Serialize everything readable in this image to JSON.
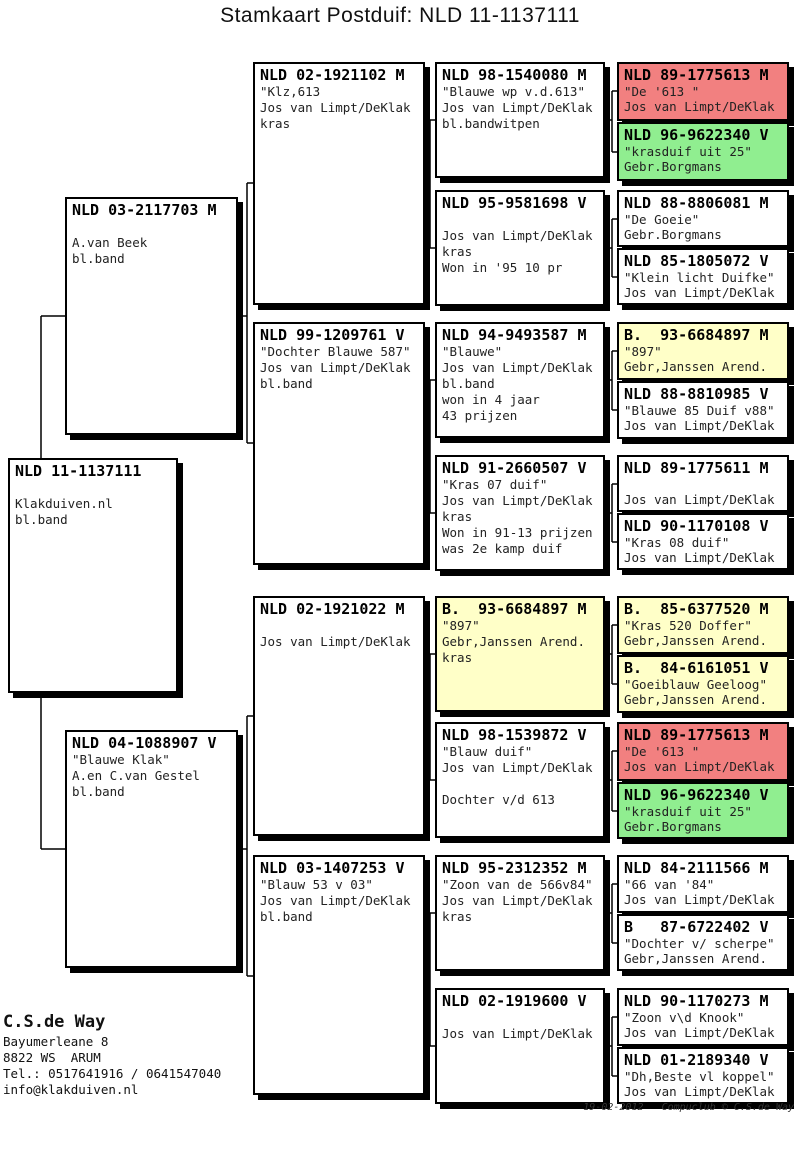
{
  "title": "Stamkaart Postduif: NLD 11-1137111",
  "colors": {
    "white": "#ffffff",
    "yellow": "#ffffc8",
    "red": "#f28080",
    "green": "#90ee90"
  },
  "boxes": [
    {
      "id": "subject",
      "header": "NLD 11-1137111",
      "body": "\nKlakduiven.nl\nbl.band"
    },
    {
      "id": "sire",
      "header": "NLD 03-2117703 M",
      "body": "\nA.van Beek\nbl.band"
    },
    {
      "id": "dam",
      "header": "NLD 04-1088907 V",
      "body": "\"Blauwe Klak\"\nA.en C.van Gestel\nbl.band"
    },
    {
      "id": "g3-1",
      "header": "NLD 02-1921102 M",
      "body": "\"Klz,613\nJos van Limpt/DeKlak\nkras"
    },
    {
      "id": "g3-2",
      "header": "NLD 99-1209761 V",
      "body": "\"Dochter Blauwe 587\"\nJos van Limpt/DeKlak\nbl.band"
    },
    {
      "id": "g3-3",
      "header": "NLD 02-1921022 M",
      "body": "\nJos van Limpt/DeKlak"
    },
    {
      "id": "g3-4",
      "header": "NLD 03-1407253 V",
      "body": "\"Blauw 53 v 03\"\nJos van Limpt/DeKlak\nbl.band"
    },
    {
      "id": "g4-1",
      "header": "NLD 98-1540080 M",
      "body": "\"Blauwe wp v.d.613\"\nJos van Limpt/DeKlak\nbl.bandwitpen"
    },
    {
      "id": "g4-2",
      "header": "NLD 95-9581698 V",
      "body": "\nJos van Limpt/DeKlak\nkras\nWon in '95 10 pr"
    },
    {
      "id": "g4-3",
      "header": "NLD 94-9493587 M",
      "body": "\"Blauwe\"\nJos van Limpt/DeKlak\nbl.band\nwon in 4 jaar\n43 prijzen"
    },
    {
      "id": "g4-4",
      "header": "NLD 91-2660507 V",
      "body": "\"Kras 07 duif\"\nJos van Limpt/DeKlak\nkras\nWon in 91-13 prijzen\nwas 2e kamp duif"
    },
    {
      "id": "g4-5",
      "header": "B.  93-6684897 M",
      "body": "\"897\"\nGebr,Janssen Arend.\nkras",
      "color": "yellow"
    },
    {
      "id": "g4-6",
      "header": "NLD 98-1539872 V",
      "body": "\"Blauw duif\"\nJos van Limpt/DeKlak\n\nDochter v/d 613"
    },
    {
      "id": "g4-7",
      "header": "NLD 95-2312352 M",
      "body": "\"Zoon van de 566v84\"\nJos van Limpt/DeKlak\nkras"
    },
    {
      "id": "g4-8",
      "header": "NLD 02-1919600 V",
      "body": "\nJos van Limpt/DeKlak"
    },
    {
      "id": "g5-01",
      "header": "NLD 89-1775613 M",
      "body": "\"De '613 \"\nJos van Limpt/DeKlak",
      "color": "red"
    },
    {
      "id": "g5-02",
      "header": "NLD 96-9622340 V",
      "body": "\"krasduif uit 25\"\nGebr.Borgmans",
      "color": "green"
    },
    {
      "id": "g5-03",
      "header": "NLD 88-8806081 M",
      "body": "\"De Goeie\"\nGebr.Borgmans"
    },
    {
      "id": "g5-04",
      "header": "NLD 85-1805072 V",
      "body": "\"Klein licht Duifke\"\nJos van Limpt/DeKlak"
    },
    {
      "id": "g5-05",
      "header": "B.  93-6684897 M",
      "body": "\"897\"\nGebr,Janssen Arend.",
      "color": "yellow"
    },
    {
      "id": "g5-06",
      "header": "NLD 88-8810985 V",
      "body": "\"Blauwe 85 Duif v88\"\nJos van Limpt/DeKlak"
    },
    {
      "id": "g5-07",
      "header": "NLD 89-1775611 M",
      "body": "\nJos van Limpt/DeKlak"
    },
    {
      "id": "g5-08",
      "header": "NLD 90-1170108 V",
      "body": "\"Kras 08 duif\"\nJos van Limpt/DeKlak"
    },
    {
      "id": "g5-09",
      "header": "B.  85-6377520 M",
      "body": "\"Kras 520 Doffer\"\nGebr,Janssen Arend.",
      "color": "yellow"
    },
    {
      "id": "g5-10",
      "header": "B.  84-6161051 V",
      "body": "\"Goeiblauw Geeloog\"\nGebr,Janssen Arend.",
      "color": "yellow"
    },
    {
      "id": "g5-11",
      "header": "NLD 89-1775613 M",
      "body": "\"De '613 \"\nJos van Limpt/DeKlak",
      "color": "red"
    },
    {
      "id": "g5-12",
      "header": "NLD 96-9622340 V",
      "body": "\"krasduif uit 25\"\nGebr.Borgmans",
      "color": "green"
    },
    {
      "id": "g5-13",
      "header": "NLD 84-2111566 M",
      "body": "\"66 van '84\"\nJos van Limpt/DeKlak"
    },
    {
      "id": "g5-14",
      "header": "B   87-6722402 V",
      "body": "\"Dochter v/ scherpe\"\nGebr,Janssen Arend."
    },
    {
      "id": "g5-15",
      "header": "NLD 90-1170273 M",
      "body": "\"Zoon v\\d Knook\"\nJos van Limpt/DeKlak"
    },
    {
      "id": "g5-16",
      "header": "NLD 01-2189340 V",
      "body": "\"Dh,Beste vl koppel\"\nJos van Limpt/DeKlak"
    }
  ],
  "footer": {
    "name": "C.S.de Way",
    "address1": "Bayumerleane 8",
    "address2": "8822 WS  ARUM",
    "phone": "Tel.: 0517641916 / 0641547040",
    "email": "info@klakduiven.nl",
    "credit": "19-02-2012   Compuclub © C.S.de Way"
  }
}
